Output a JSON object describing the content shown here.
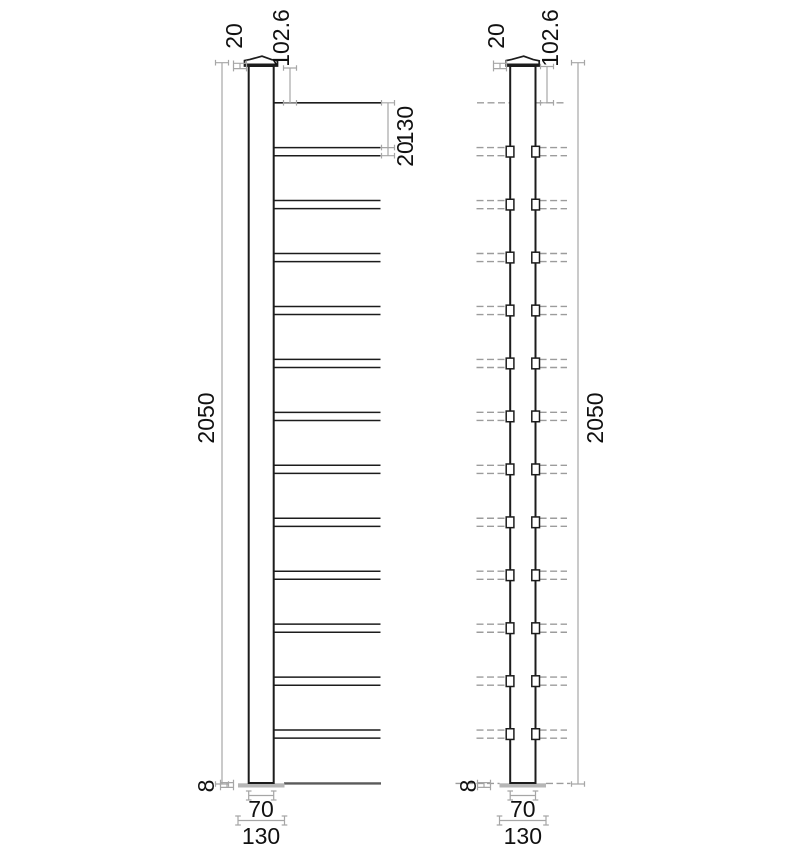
{
  "labels": {
    "overall_height": "2050",
    "top_offset": "102.6",
    "cap_height": "20",
    "rail_spacing": "130",
    "rail_thickness": "20",
    "plate_thickness": "8",
    "post_width": "70",
    "plate_width": "130"
  },
  "structure": {
    "rail_count": 12
  },
  "colors": {
    "line": "#1c1c1c",
    "dim": "#a6a6a6",
    "dash": "#9c9c9c",
    "plate": "#b6b6b6",
    "ground": "#5a5a5a",
    "text": "#111111",
    "background": "#ffffff"
  }
}
